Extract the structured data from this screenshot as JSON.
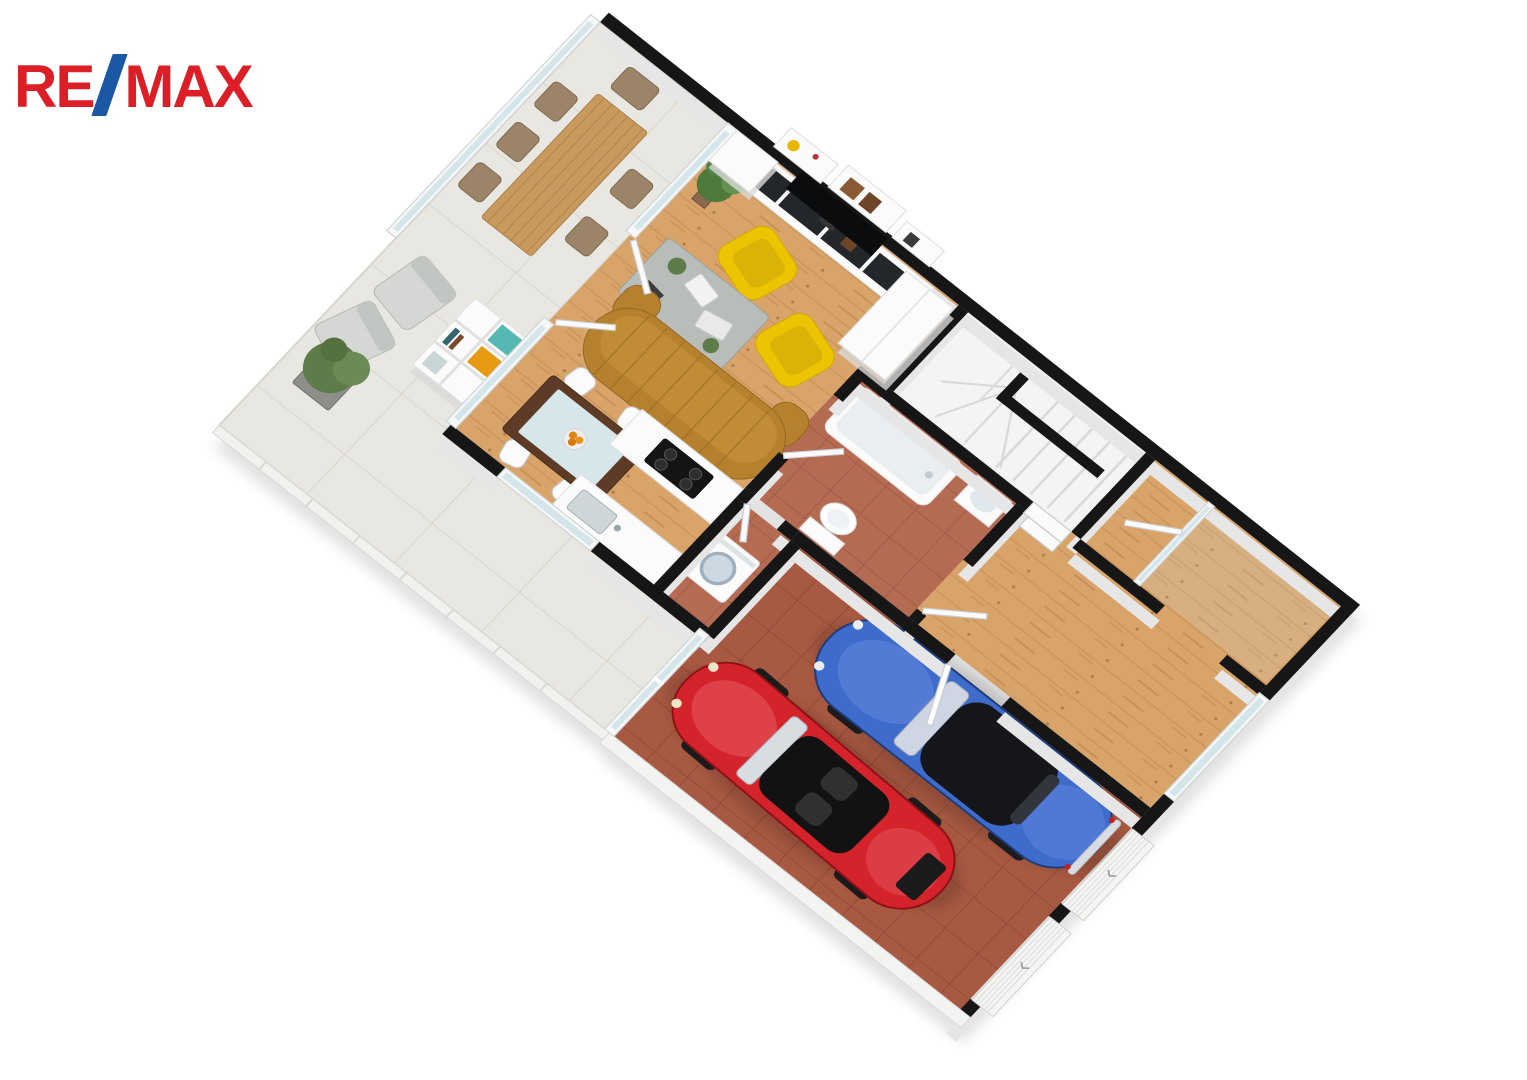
{
  "page": {
    "background": "#ffffff",
    "description": "3D isometric floor plan render of a ground floor: terrace with outdoor dining and lounge set, living room with mustard sofa and two yellow armchairs, TV wall, dining table, kitchen, bathroom, utility room with washing machine, winder staircase, hallway, glazed entry and a double garage with a blue classic car and a red convertible"
  },
  "logo": {
    "re": "RE",
    "slash": "/",
    "max": "MAX",
    "red": "#DC1F26",
    "blue": "#1A57A5"
  },
  "palette": {
    "wall": "#161616",
    "wall_face": "#e6e6e6",
    "wood": "#d9a46a",
    "wood_line": "#bf8b51",
    "terracotta_garage": "#a85941",
    "terracotta_garage_line": "#8f4733",
    "terracotta_bath": "#b56a52",
    "terracotta_bath_line": "#9c5540",
    "terrace_tile": "#e9e7e1",
    "terrace_tile_line": "#d3d0c7",
    "stair_floor": "#f2f2f2",
    "glass": "#cfe3e8",
    "frame_white": "#f6f7f7",
    "sofa": "#b5812e",
    "armchair_yellow": "#ecc400",
    "coffee_table": "#b9bdb9",
    "dining_table_dark": "#5d3b26",
    "dining_glass_top": "#d7e6e9",
    "outdoor_table": "#c99a5e",
    "kallax_teal": "#55b8b2",
    "kallax_orange": "#e59a12",
    "car_blue": "#3f6ccc",
    "car_blue_dark": "#1d3c7a",
    "car_red": "#d5232b",
    "car_red_dark": "#8e1118",
    "plant_green": "#5d7c49"
  }
}
